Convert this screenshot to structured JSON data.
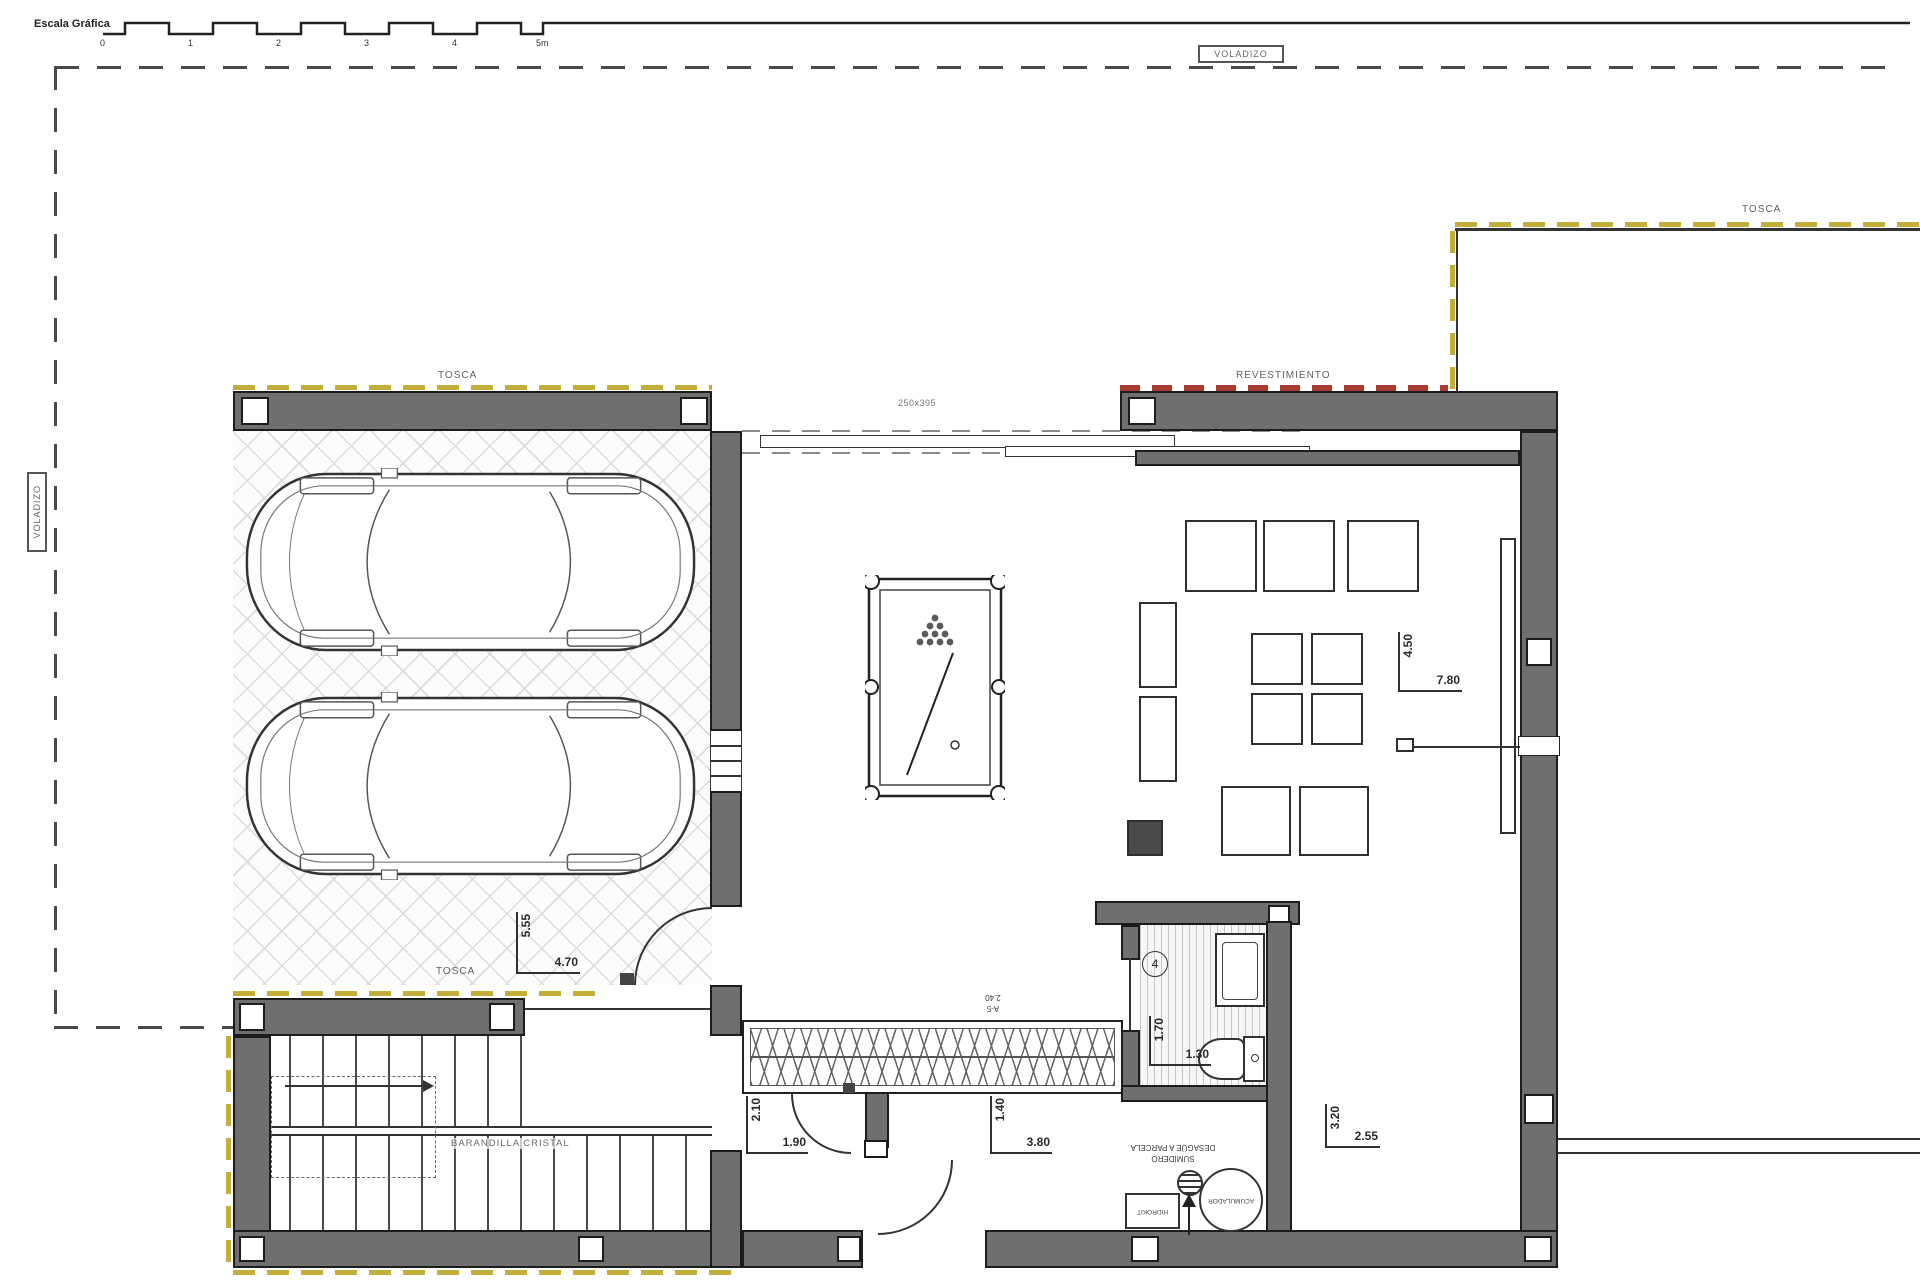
{
  "plan": {
    "scale": {
      "label": "Escala Gráfica",
      "ticks": [
        "0",
        "1",
        "2",
        "3",
        "4",
        "5m"
      ]
    },
    "annotations": {
      "voladizo_top": "VOLADIZO",
      "voladizo_left": "VOLADIZO",
      "tosca_garage_top": "TOSCA",
      "tosca_garage_bottom": "TOSCA",
      "tosca_terrace": "TOSCA",
      "revestimiento": "REVESTIMIENTO",
      "beam_size": "250x395",
      "stair_railing": "BARANDILLA CRISTAL",
      "room_number": "4",
      "vent_ref_line1": "A-5",
      "vent_ref_line2": "2.40",
      "drain_line1": "SUMIDERO",
      "drain_line2": "DESAGÜE A PARCELA",
      "accumulator": "ACUMULADOR",
      "hydrokit": "HIDROKIT"
    },
    "dimensions": {
      "garage": {
        "v": "5.55",
        "h": "4.70"
      },
      "living": {
        "v": "4.50",
        "h": "7.80"
      },
      "stair_hall": {
        "v": "2.10",
        "h": "1.90"
      },
      "corridor": {
        "v": "1.40",
        "h": "3.80"
      },
      "bathroom": {
        "v": "1.70",
        "h": "1.30"
      },
      "store": {
        "v": "3.20",
        "h": "2.55"
      }
    },
    "colors": {
      "wall_fill": "#6f6f6f",
      "wall_outline": "#1c1c1c",
      "tosca_dash": "#c4ae3a",
      "revestimiento_dash": "#ab3a30",
      "voladizo_dash": "#4a4a4a"
    }
  }
}
